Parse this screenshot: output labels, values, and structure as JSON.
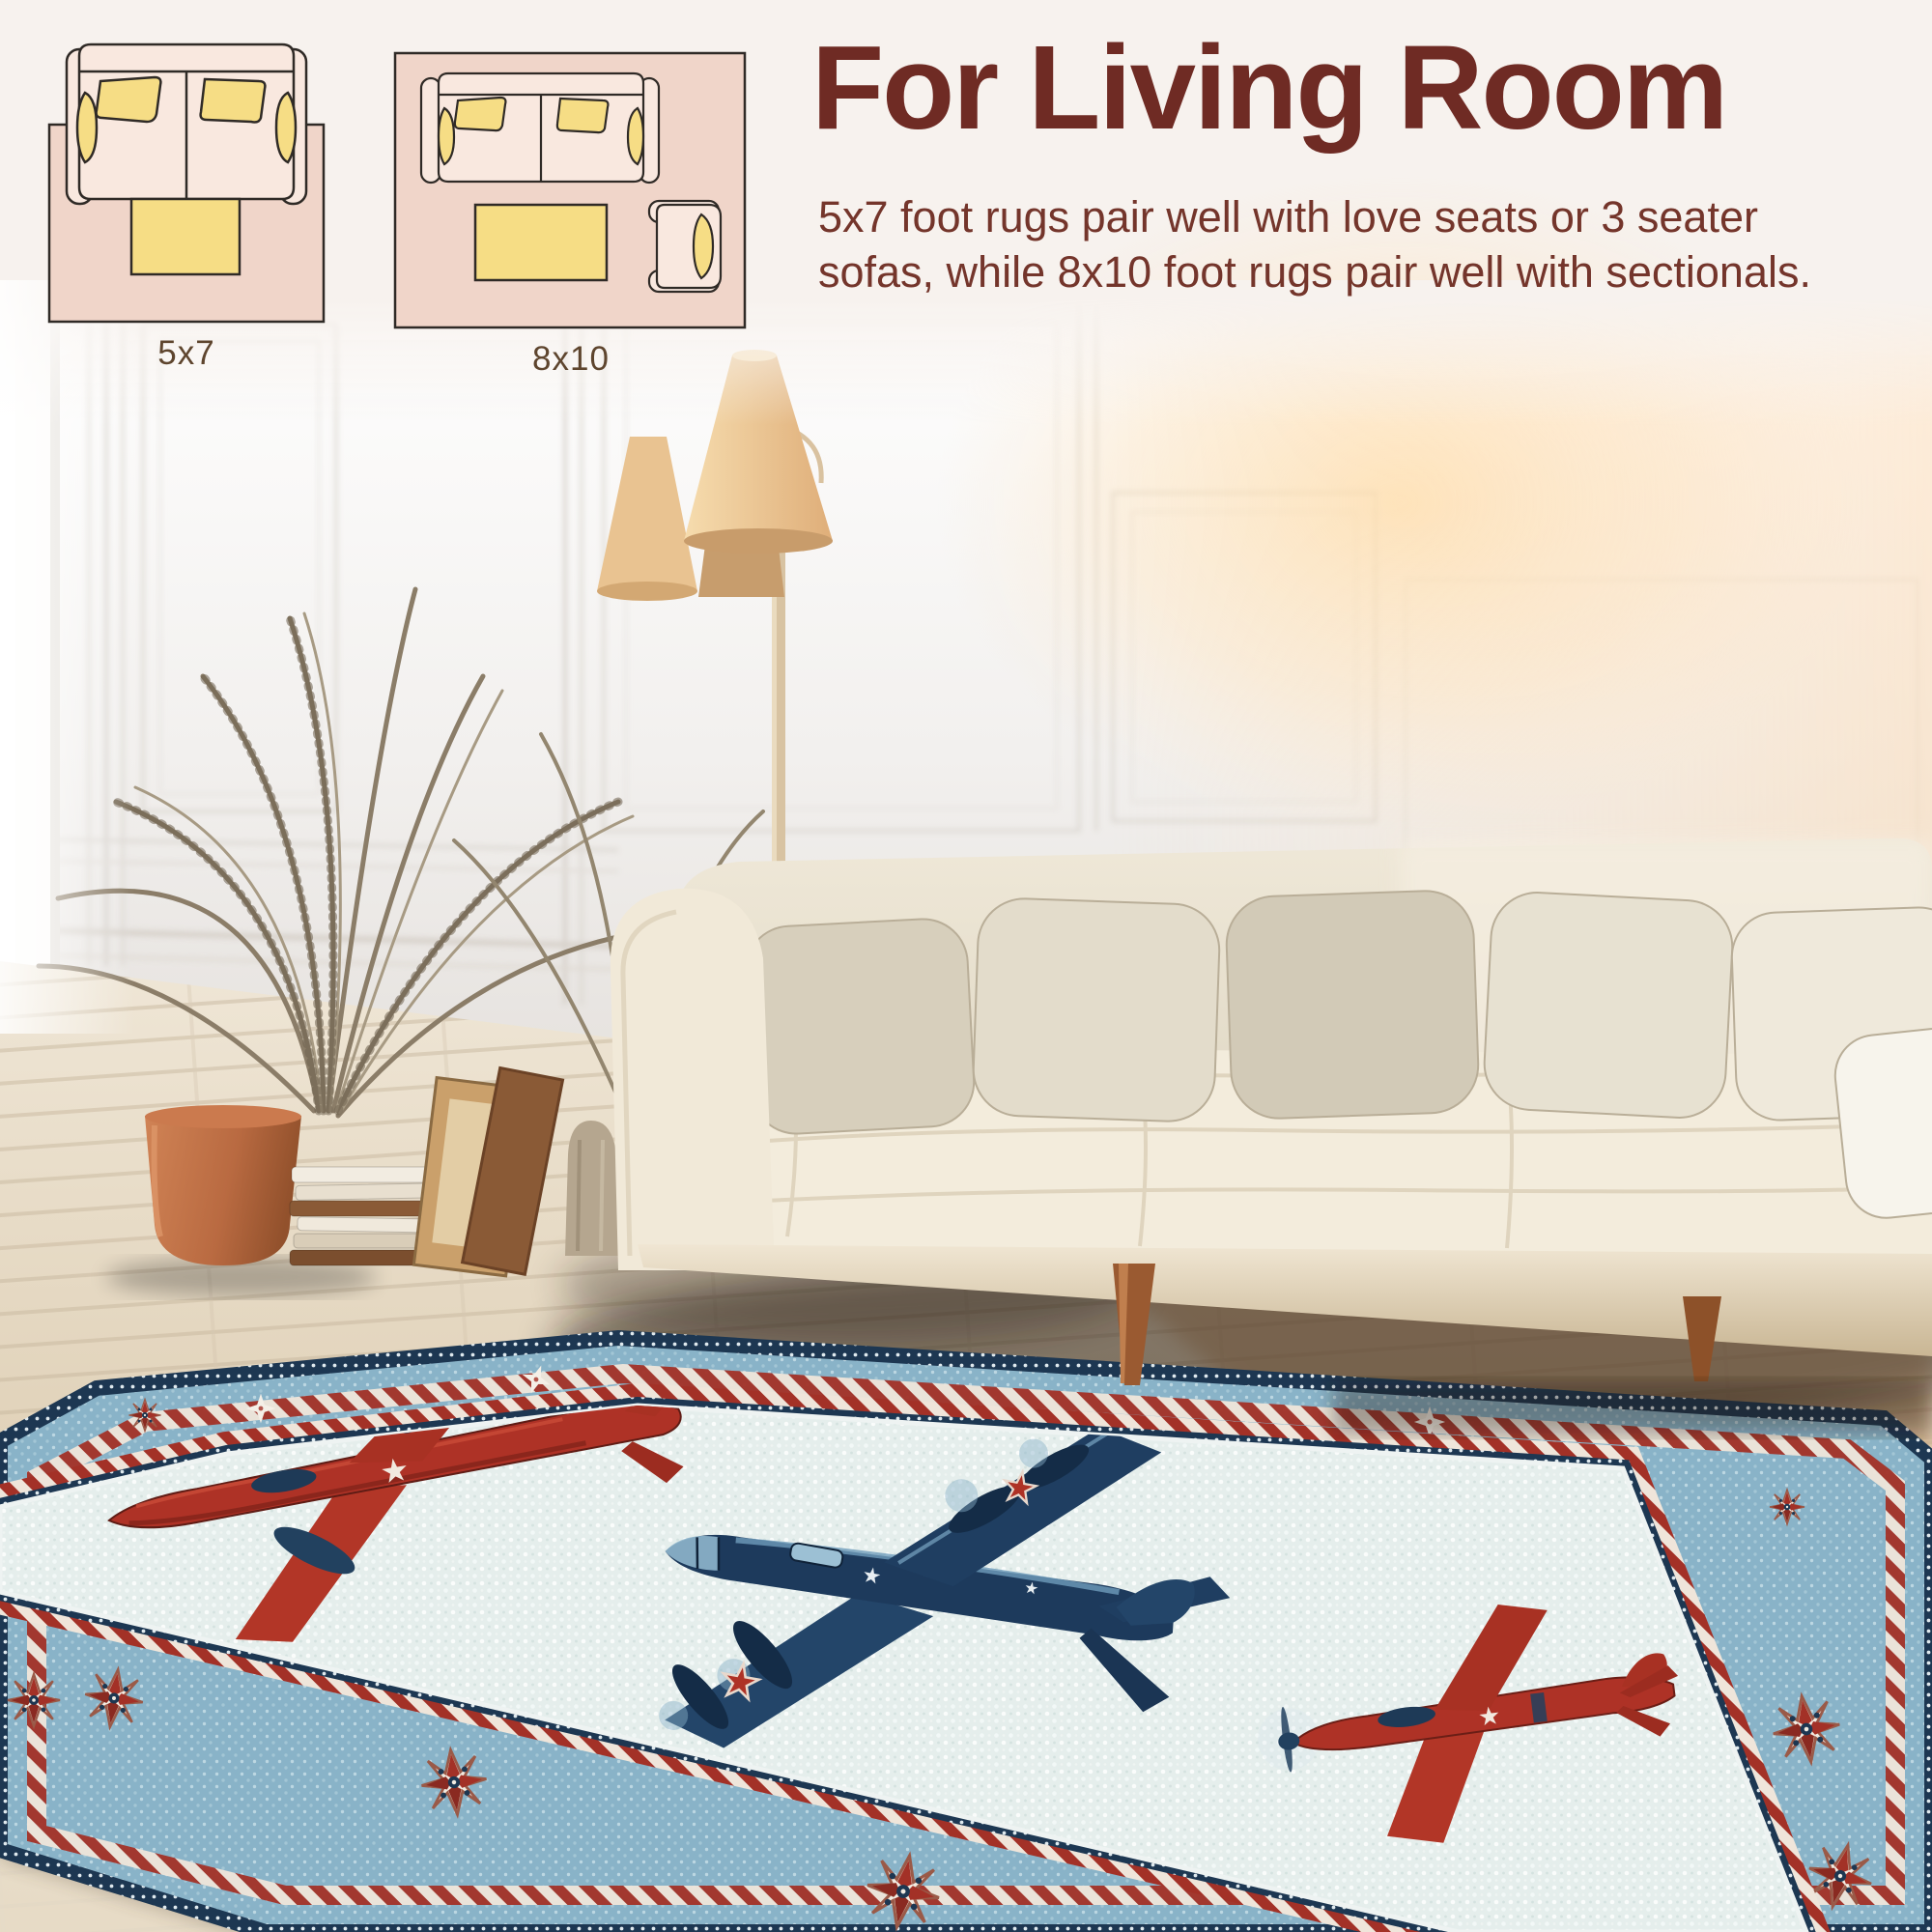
{
  "page": {
    "background_color": "#f7f2ee"
  },
  "header": {
    "title": "For Living Room",
    "title_color": "#6f2b24",
    "description_lines": [
      "5x7 foot rugs pair well with love seats or 3 seater",
      "sofas, while 8x10 foot rugs pair well with sectionals."
    ],
    "text_color": "#74352b"
  },
  "size_diagrams": {
    "label_color": "#5e452e",
    "rug_color": "#f0d5c9",
    "furniture_fill": "#f9e8df",
    "cushion_color": "#f6dd85",
    "outline_color": "#2f2a26",
    "items": [
      {
        "label": "5x7",
        "furniture": [
          "loveseat-sofa-top-view",
          "coffee-table"
        ]
      },
      {
        "label": "8x10",
        "furniture": [
          "three-seater-sofa-top-view",
          "coffee-table",
          "armchair-top-view"
        ]
      }
    ]
  },
  "scene": {
    "subject": "living-room photo with airplane print rug",
    "wall_color": "#f0eeec",
    "floor_color": "#e8dfcd",
    "sofa_color": "#f2ead9",
    "pillow_colors": [
      "#d7cfbc",
      "#e3dccb",
      "#d2cab7",
      "#e7e1d1",
      "#efe9db"
    ],
    "lamp_shade_color": "#ecc795",
    "plant_pot_color": "#bb6e45",
    "rug": {
      "field_color": "#e5eeec",
      "band_color": "#89b3c8",
      "navy_color": "#1d3752",
      "red_color": "#a33127",
      "motifs": [
        "compass-star-medallion",
        "candy-checker-stripe",
        "dotted-weave-texture"
      ],
      "planes": [
        {
          "name": "red-twin-engine-plane"
        },
        {
          "name": "navy-bomber-plane"
        },
        {
          "name": "red-fighter-plane"
        }
      ]
    }
  },
  "icons": {
    "loveseat-sofa-icon": "top-view sofa shape",
    "armchair-icon": "top-view armchair shape",
    "coffee-table-icon": "yellow rectangle",
    "compass-star-icon": "8-point star medallion",
    "airplane-icon": "vintage airplane top view"
  }
}
